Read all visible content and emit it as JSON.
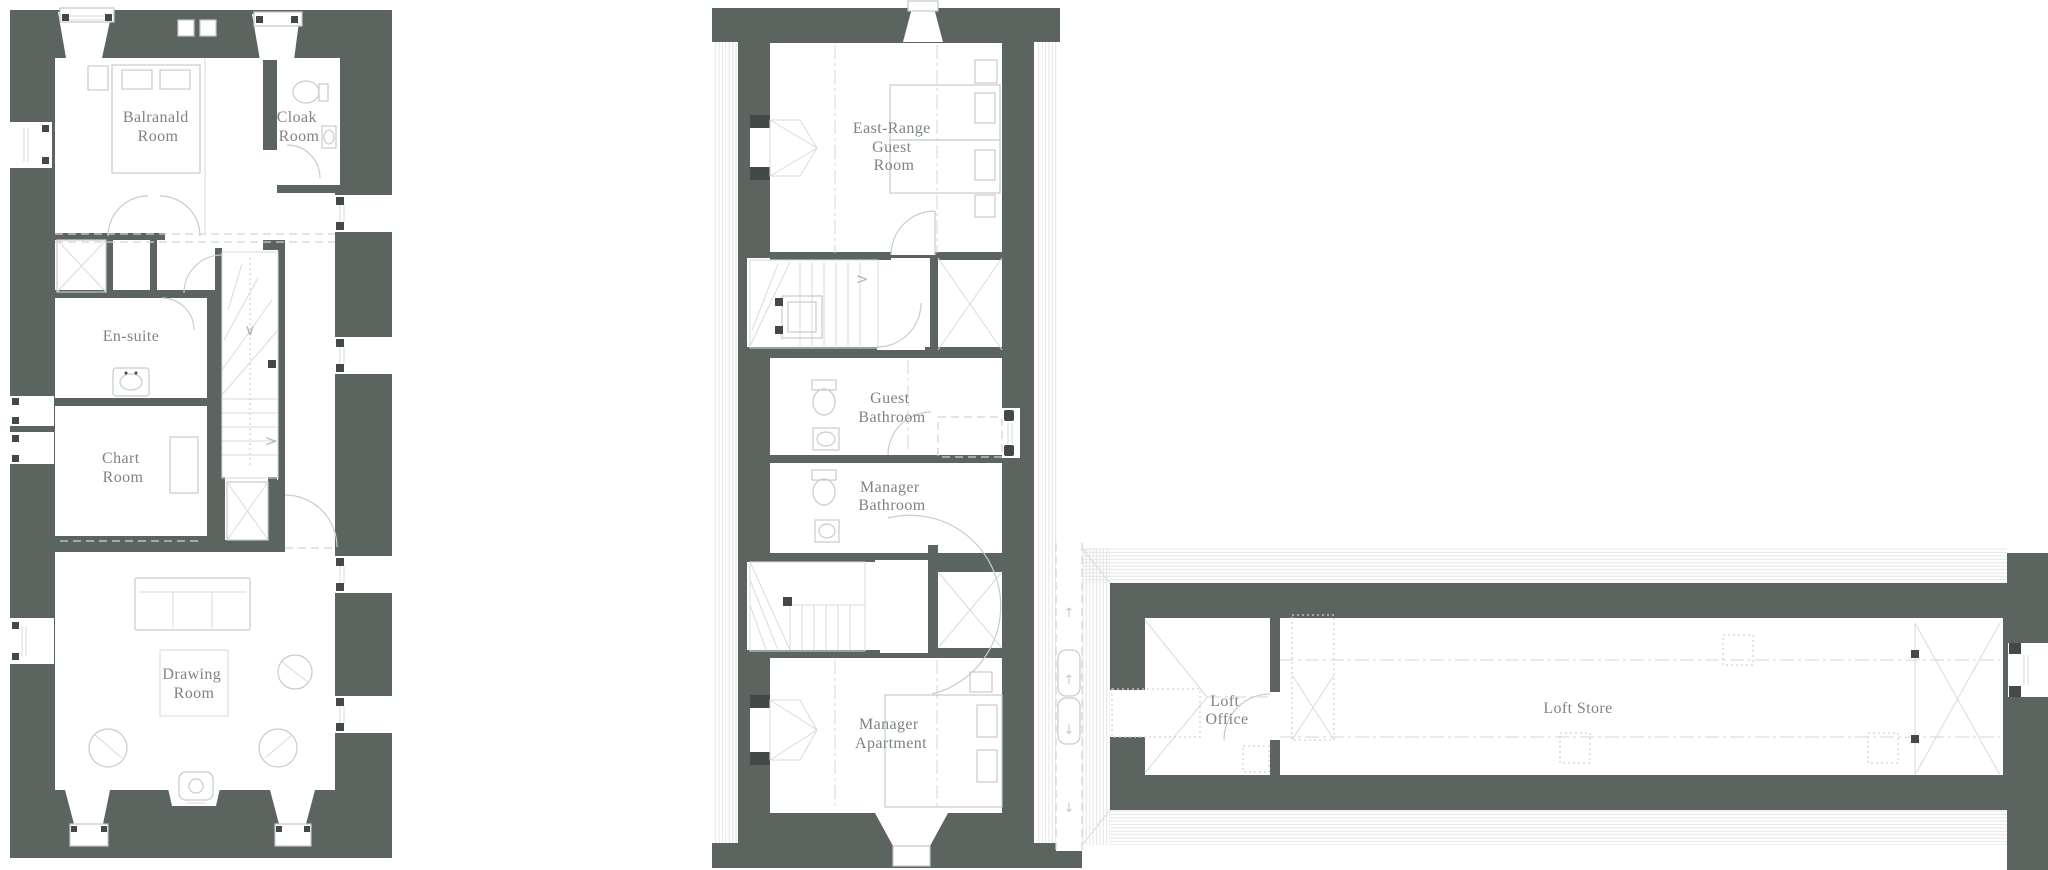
{
  "document": {
    "type": "architectural-floor-plans",
    "background": "#ffffff"
  },
  "colors": {
    "wall": "#5c6460",
    "furniture_line": "#c6ccc9",
    "dashed_line": "#ced3d1",
    "hatch_line": "#e2e5e3",
    "label_text": "#7c8581",
    "jamb_mark": "#424946"
  },
  "plans": {
    "main_house": {
      "rooms": {
        "balranald": {
          "lines": [
            "Balranald",
            "Room"
          ]
        },
        "cloak": {
          "lines": [
            "Cloak",
            "Room"
          ]
        },
        "en_suite": {
          "lines": [
            "En-suite"
          ]
        },
        "chart": {
          "lines": [
            "Chart",
            "Room"
          ]
        },
        "drawing": {
          "lines": [
            "Drawing",
            "Room"
          ]
        }
      }
    },
    "east_range": {
      "rooms": {
        "east_range_guest": {
          "lines": [
            "East-Range",
            "Guest",
            "Room"
          ]
        },
        "guest_bathroom": {
          "lines": [
            "Guest",
            "Bathroom"
          ]
        },
        "manager_bathroom": {
          "lines": [
            "Manager",
            "Bathroom"
          ]
        },
        "manager_apartment": {
          "lines": [
            "Manager",
            "Apartment"
          ]
        }
      }
    },
    "loft": {
      "rooms": {
        "loft_office": {
          "lines": [
            "Loft",
            "Office"
          ]
        },
        "loft_store": {
          "lines": [
            "Loft Store"
          ]
        }
      }
    }
  },
  "icons": {
    "stair_down_chevron": "∨",
    "stair_right_chevron": ">",
    "walkway_arrow_up": "↑",
    "walkway_arrow_down": "↓"
  }
}
